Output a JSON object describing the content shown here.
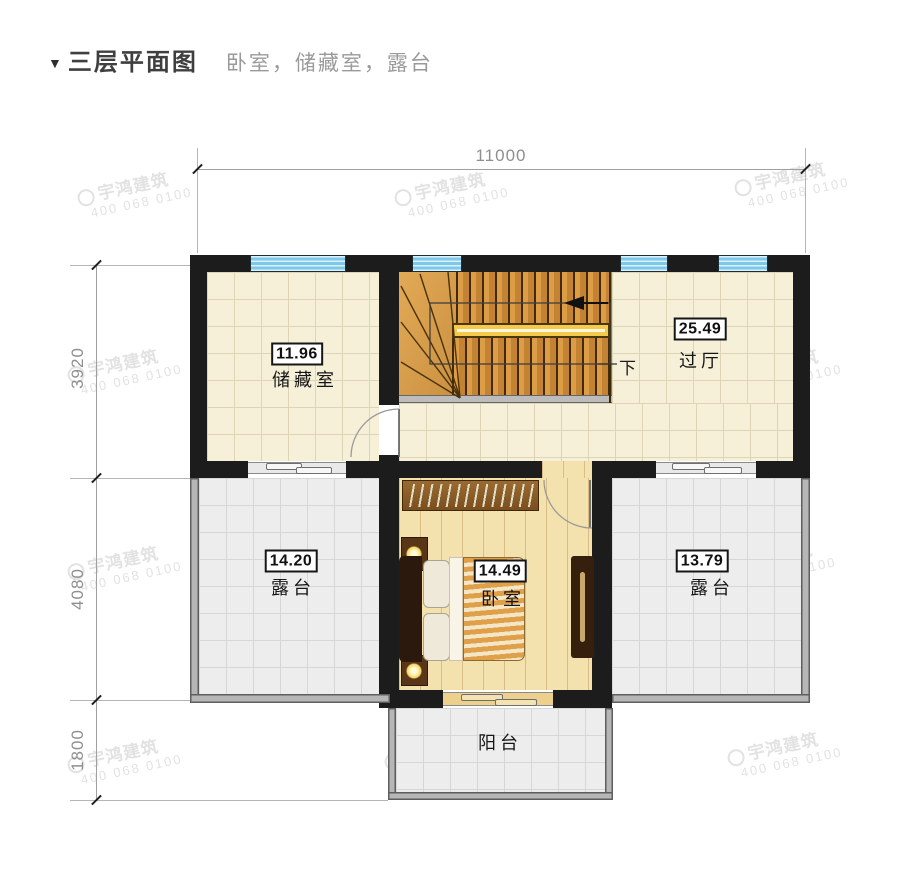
{
  "title": {
    "marker": "▼",
    "text": "三层平面图",
    "subtitle": "卧室，储藏室，露台"
  },
  "dimensions": {
    "top": "11000",
    "left_top": "3920",
    "left_mid": "4080",
    "left_bottom": "1800"
  },
  "rooms": {
    "storage": {
      "area": "11.96",
      "name": "储藏室"
    },
    "hall": {
      "area": "25.49",
      "name": "过厅"
    },
    "terrace_left": {
      "area": "14.20",
      "name": "露台"
    },
    "bedroom": {
      "area": "14.49",
      "name": "卧室"
    },
    "terrace_right": {
      "area": "13.79",
      "name": "露台"
    },
    "balcony": {
      "name": "阳台"
    }
  },
  "stairs": {
    "down_label": "下"
  },
  "watermark": {
    "brand": "宇鸿建筑",
    "phone": "400 068 0100"
  },
  "icons": {
    "title_marker": "down-triangle-icon",
    "watermark_logo": "circle-logo-icon"
  },
  "colors": {
    "wall": "#1c1c1c",
    "window_glass": "#7cc9ea",
    "floor_cream": "#f6f0d9",
    "floor_gray": "#ededed",
    "wood_floor": "#f3e2ae",
    "stair_wood": "#d79440",
    "handrail": "#f3ca4b",
    "dimension_gray": "#8f8f8f",
    "watermark_gray": "#cbcbcb"
  }
}
